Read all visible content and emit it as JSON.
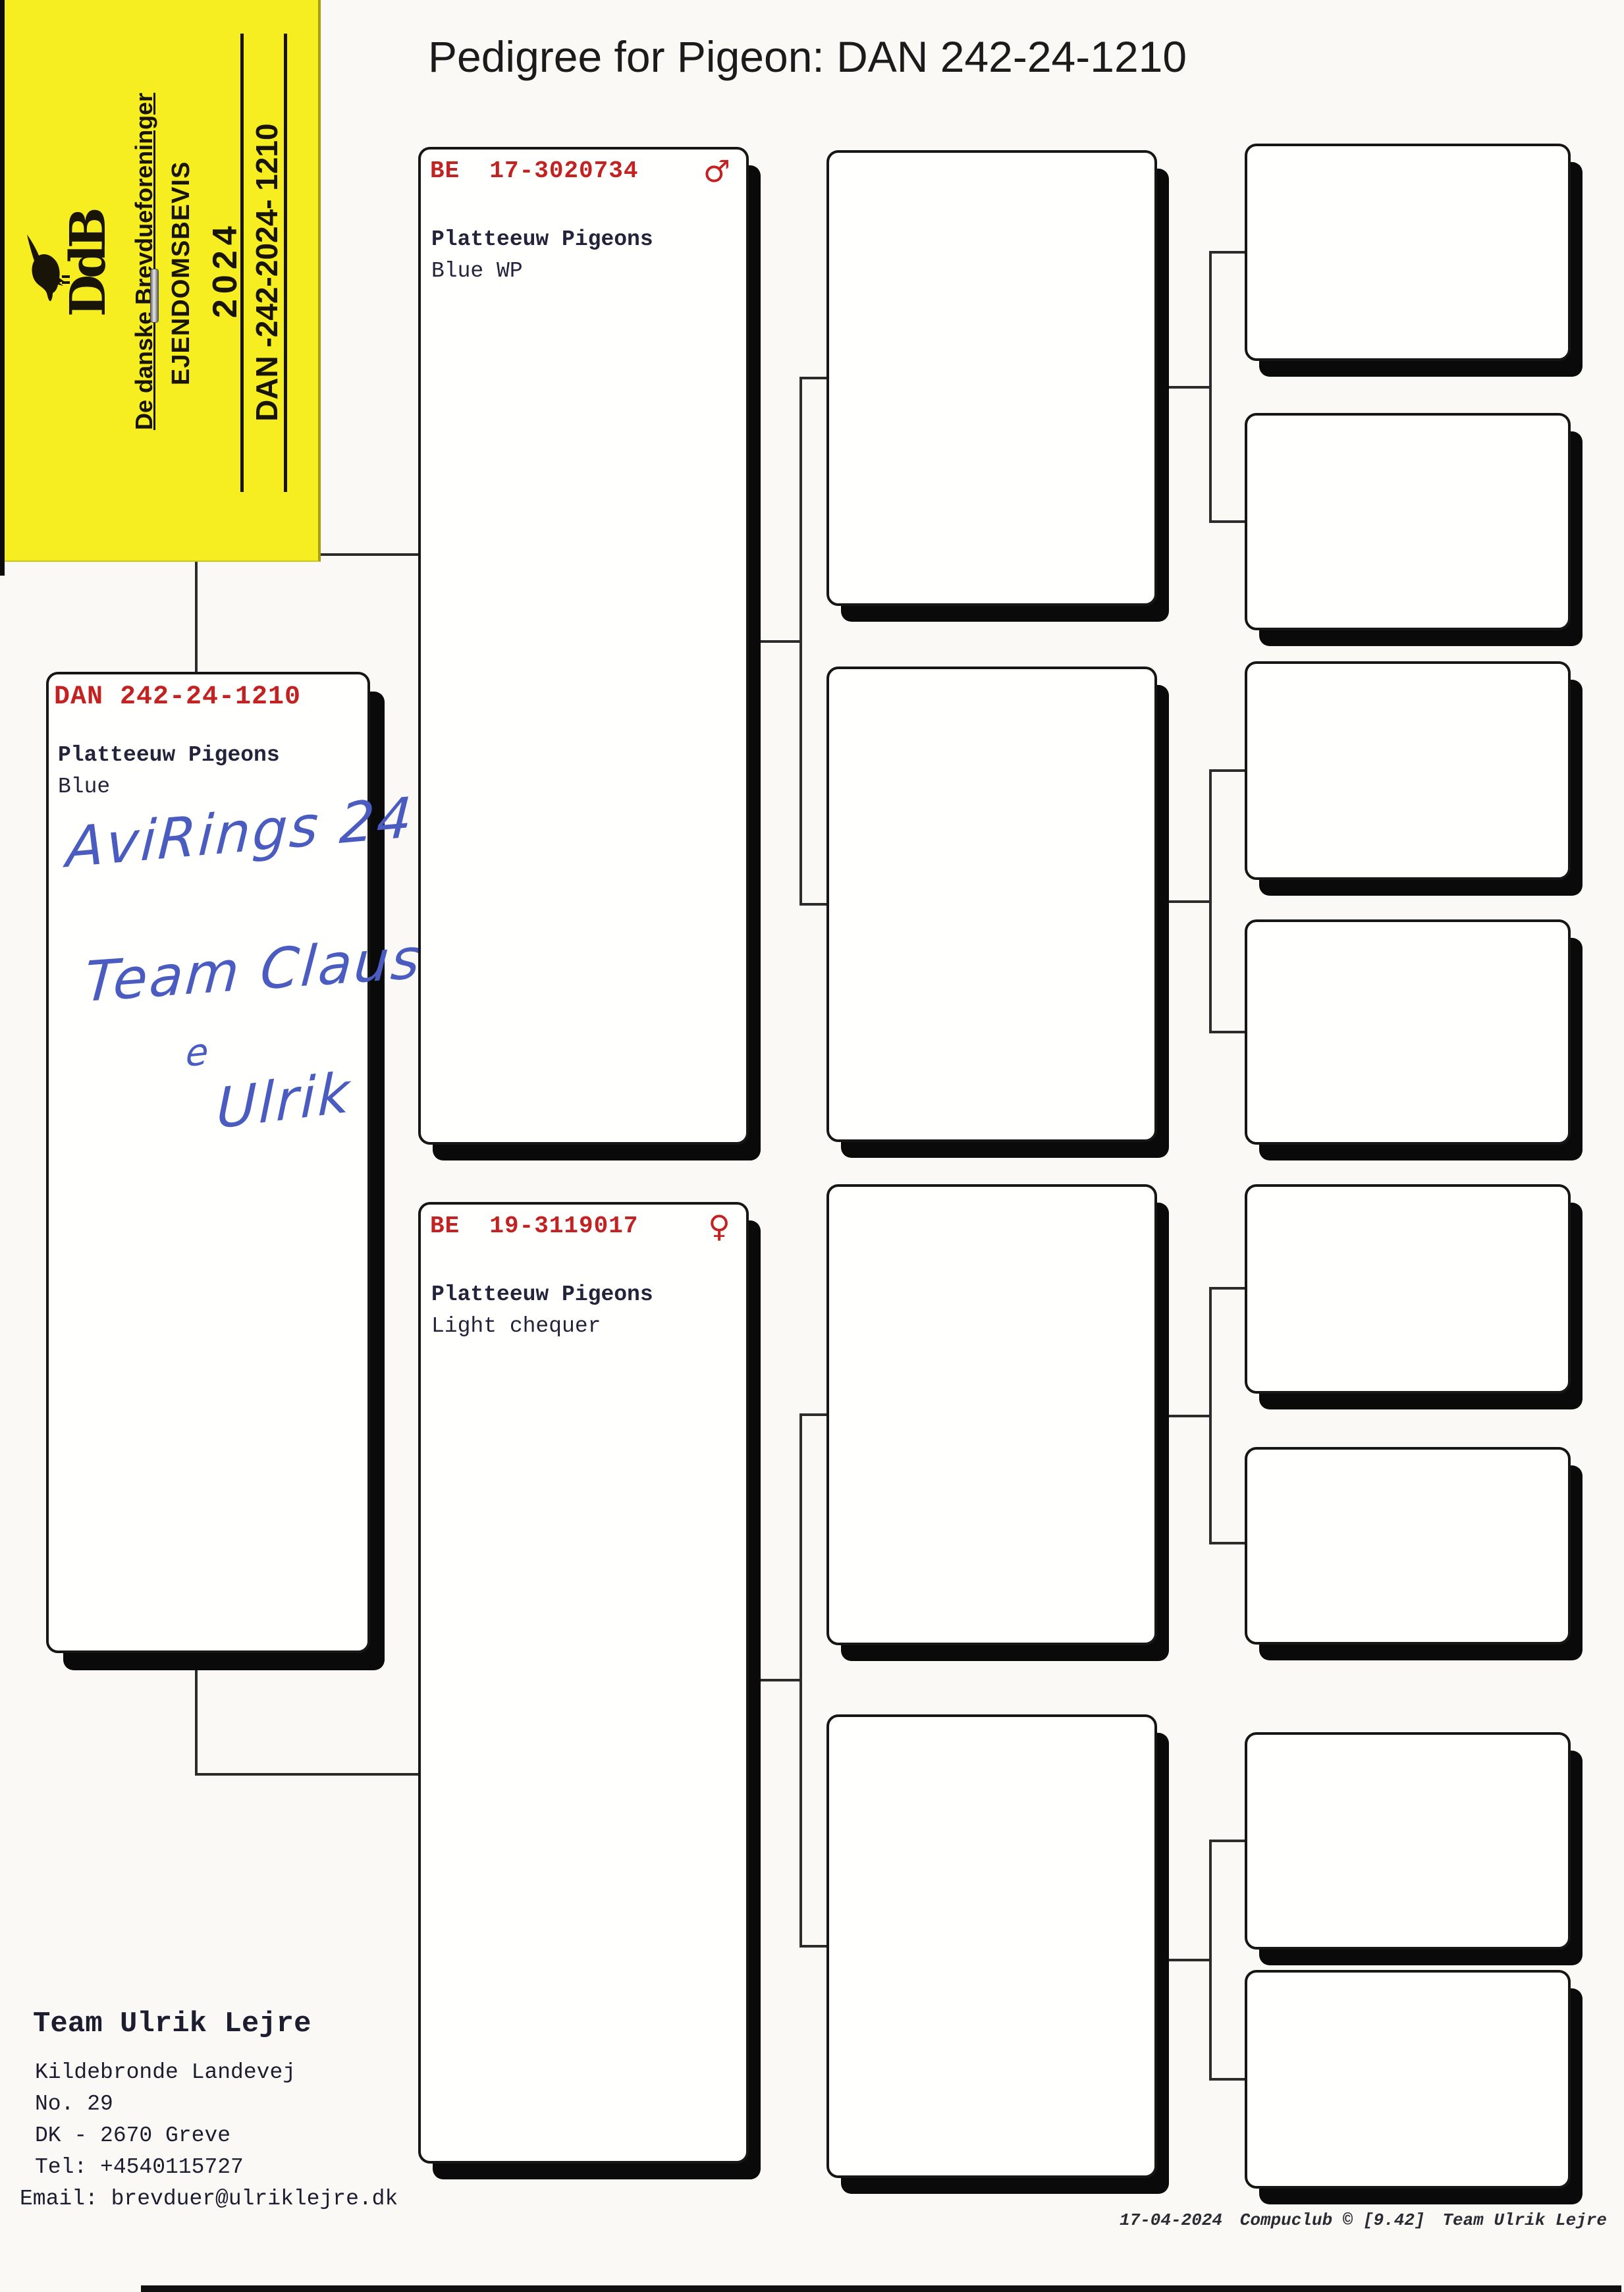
{
  "title": "Pedigree for Pigeon: DAN 242-24-1210",
  "sticker": {
    "org": "De danske Brevdueforeninger",
    "cert": "EJENDOMSBEVIS",
    "year": "2024",
    "ring": "DAN -242-2024- 1210",
    "monogram": "DdB"
  },
  "subject": {
    "ring": "DAN 242-24-1210",
    "loft": "Platteeuw Pigeons",
    "colour": "Blue",
    "note1": "AviRings 24",
    "note2": "Team Claus",
    "note3": "e",
    "note4": "Ulrik"
  },
  "sire": {
    "ring": "BE  17-3020734",
    "sex": "♂",
    "loft": "Platteeuw Pigeons",
    "colour": "Blue WP"
  },
  "dam": {
    "ring": "BE  19-3119017",
    "sex": "♀",
    "loft": "Platteeuw Pigeons",
    "colour": "Light chequer"
  },
  "owner": {
    "name": "Team Ulrik Lejre",
    "street": "Kildebronde Landevej",
    "number": "No. 29",
    "city": "DK - 2670 Greve",
    "phone": "Tel: +4540115727",
    "email": "Email: brevduer@ulriklejre.dk"
  },
  "footer": {
    "date": "17-04-2024",
    "software": "Compuclub © [9.42]",
    "author": "Team Ulrik Lejre"
  },
  "colors": {
    "accent_red": "#c32222",
    "ink_blue": "#4a5cc0",
    "sticker_yellow": "#f6ee20"
  }
}
